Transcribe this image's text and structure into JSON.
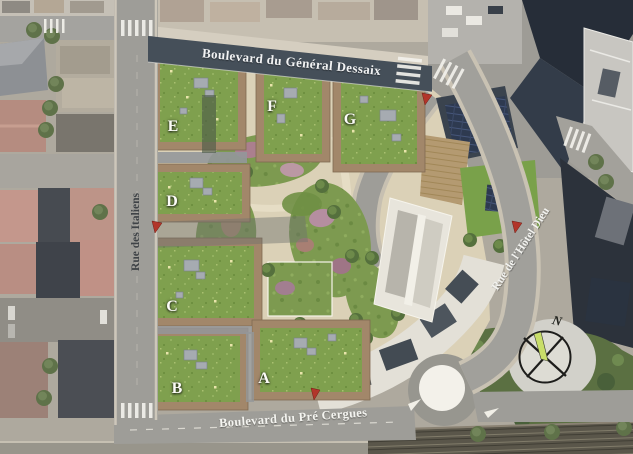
{
  "plan": {
    "streets": {
      "top": "Boulevard du Général Dessaix",
      "left": "Rue des Italiens",
      "right": "Rue de l'Hôtel Dieu",
      "bottom": "Boulevard du Pré Cergues"
    },
    "buildings": [
      {
        "label": "A"
      },
      {
        "label": "B"
      },
      {
        "label": "C"
      },
      {
        "label": "D"
      },
      {
        "label": "E"
      },
      {
        "label": "F"
      },
      {
        "label": "G"
      }
    ],
    "compass": {
      "north": "N"
    },
    "colors": {
      "road_dark": "#454f59",
      "road_gray": "#9e9d98",
      "site_ground": "#dbd1b7",
      "green_roof": "#7fa04e",
      "building_trim": "#a2876a",
      "garden_green": "#7d9a50",
      "lawn": "#79a14a",
      "marker_red": "#b2352a",
      "compass_pointer": "#c9de69"
    }
  }
}
